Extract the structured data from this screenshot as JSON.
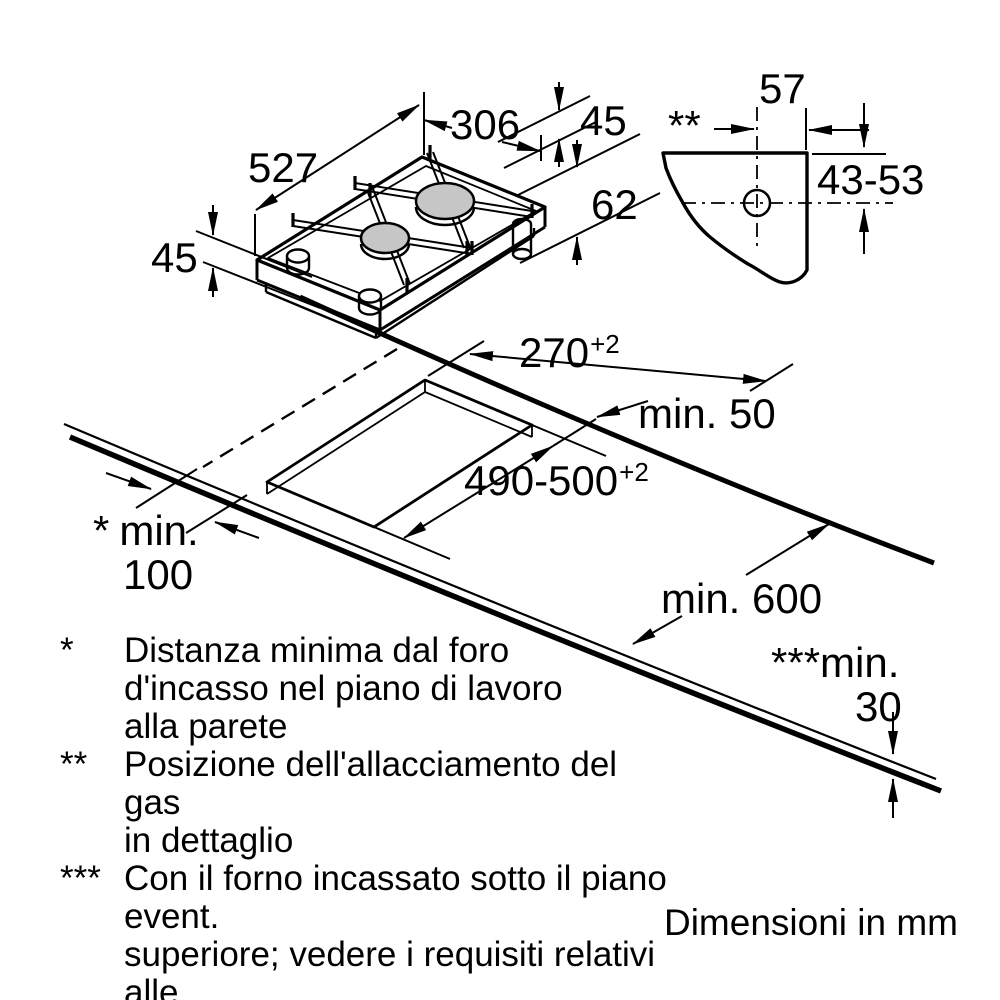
{
  "hob_view": {
    "width": "306",
    "depth": "527",
    "body_height_right": "45",
    "body_height_left": "45",
    "total_height_with_gas": "62"
  },
  "gas_detail": {
    "marker": "**",
    "offset_from_edge": "57",
    "vertical_offset_range": "43-53"
  },
  "worktop_view": {
    "cutout_width": "270",
    "cutout_width_tol": "+2",
    "cutout_depth": "490-500",
    "cutout_depth_tol": "+2",
    "rear_clearance": "min. 50",
    "worktop_depth": "min. 600",
    "wall_clearance_marker": "*",
    "wall_clearance_label": "min.",
    "wall_clearance_value": "100",
    "oven_clearance_label": "***min.",
    "oven_clearance_value": "30"
  },
  "footnotes": [
    {
      "marker": "*",
      "lines": [
        "Distanza minima dal foro",
        "d'incasso nel piano di lavoro",
        "alla parete"
      ]
    },
    {
      "marker": "**",
      "lines": [
        "Posizione dell'allacciamento del gas",
        "in dettaglio"
      ]
    },
    {
      "marker": "***",
      "lines": [
        "Con il forno incassato sotto il piano event.",
        "superiore; vedere i requisiti relativi alle",
        "dimensioni del forno"
      ]
    }
  ],
  "units_note": "Dimensioni in mm"
}
